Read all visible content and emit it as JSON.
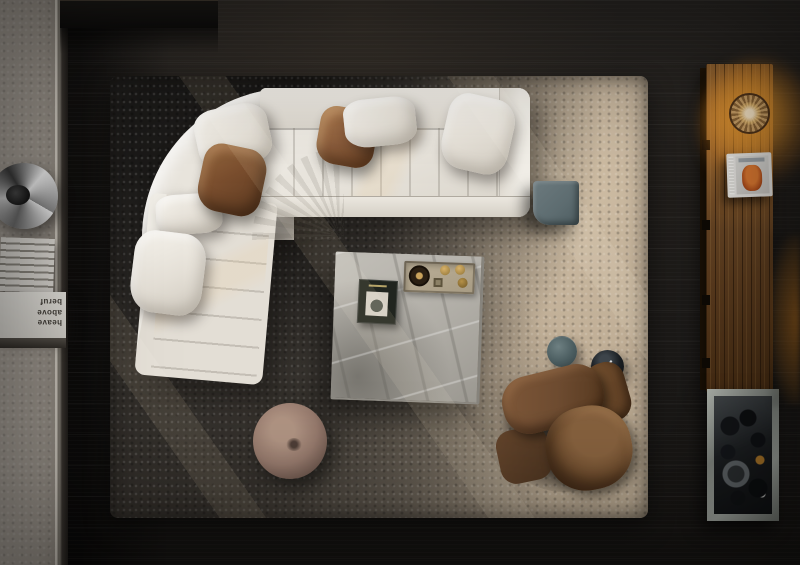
{
  "meta": {
    "title": "Top-down living room with sectional sofa and shag rug"
  },
  "left_shelf": {
    "book_titles": [
      "heave",
      "above",
      "beruf"
    ]
  },
  "objects": [
    {
      "name": "dark-console",
      "label": "dark wood console"
    },
    {
      "name": "concrete-platform",
      "label": "concrete shelf platform"
    },
    {
      "name": "chrome-sculpture",
      "label": "chrome ring sculpture"
    },
    {
      "name": "magazine-stack",
      "label": "stack of white magazines"
    },
    {
      "name": "shag-rug",
      "label": "charcoal-to-taupe shag rug"
    },
    {
      "name": "sectional-sofa",
      "label": "white channel-stitched sectional sofa"
    },
    {
      "name": "throw-pillows",
      "label": "white and tan leather pillows"
    },
    {
      "name": "coffee-table",
      "label": "square marble coffee table"
    },
    {
      "name": "art-book",
      "label": "dark art book"
    },
    {
      "name": "decor-tray",
      "label": "tray with brass dishes"
    },
    {
      "name": "cube-side-table",
      "label": "grey cube side table"
    },
    {
      "name": "teal-side-table",
      "label": "teal round side table"
    },
    {
      "name": "black-side-table",
      "label": "black round side table"
    },
    {
      "name": "remote",
      "label": "remote control"
    },
    {
      "name": "leather-armchair",
      "label": "brown leather armchair"
    },
    {
      "name": "pouf",
      "label": "round taupe pouf"
    },
    {
      "name": "tall-cabinet",
      "label": "walnut cabinet with rattan sconce, book and marble vitrine"
    }
  ],
  "palette": {
    "floor": "#1c1a18",
    "concrete": "#a39d94",
    "rug_dark": "#2c2a28",
    "rug_light": "#c3b29c",
    "sofa": "#e8e4dc",
    "pillow_leather": "#8a5c3b",
    "armchair": "#6e4c31",
    "pouf": "#95796c",
    "marble": "#b1aea7",
    "wood": "#6e4a27",
    "glow": "#e89a3c",
    "cube": "#5d6c70",
    "teal": "#4b5d60"
  }
}
